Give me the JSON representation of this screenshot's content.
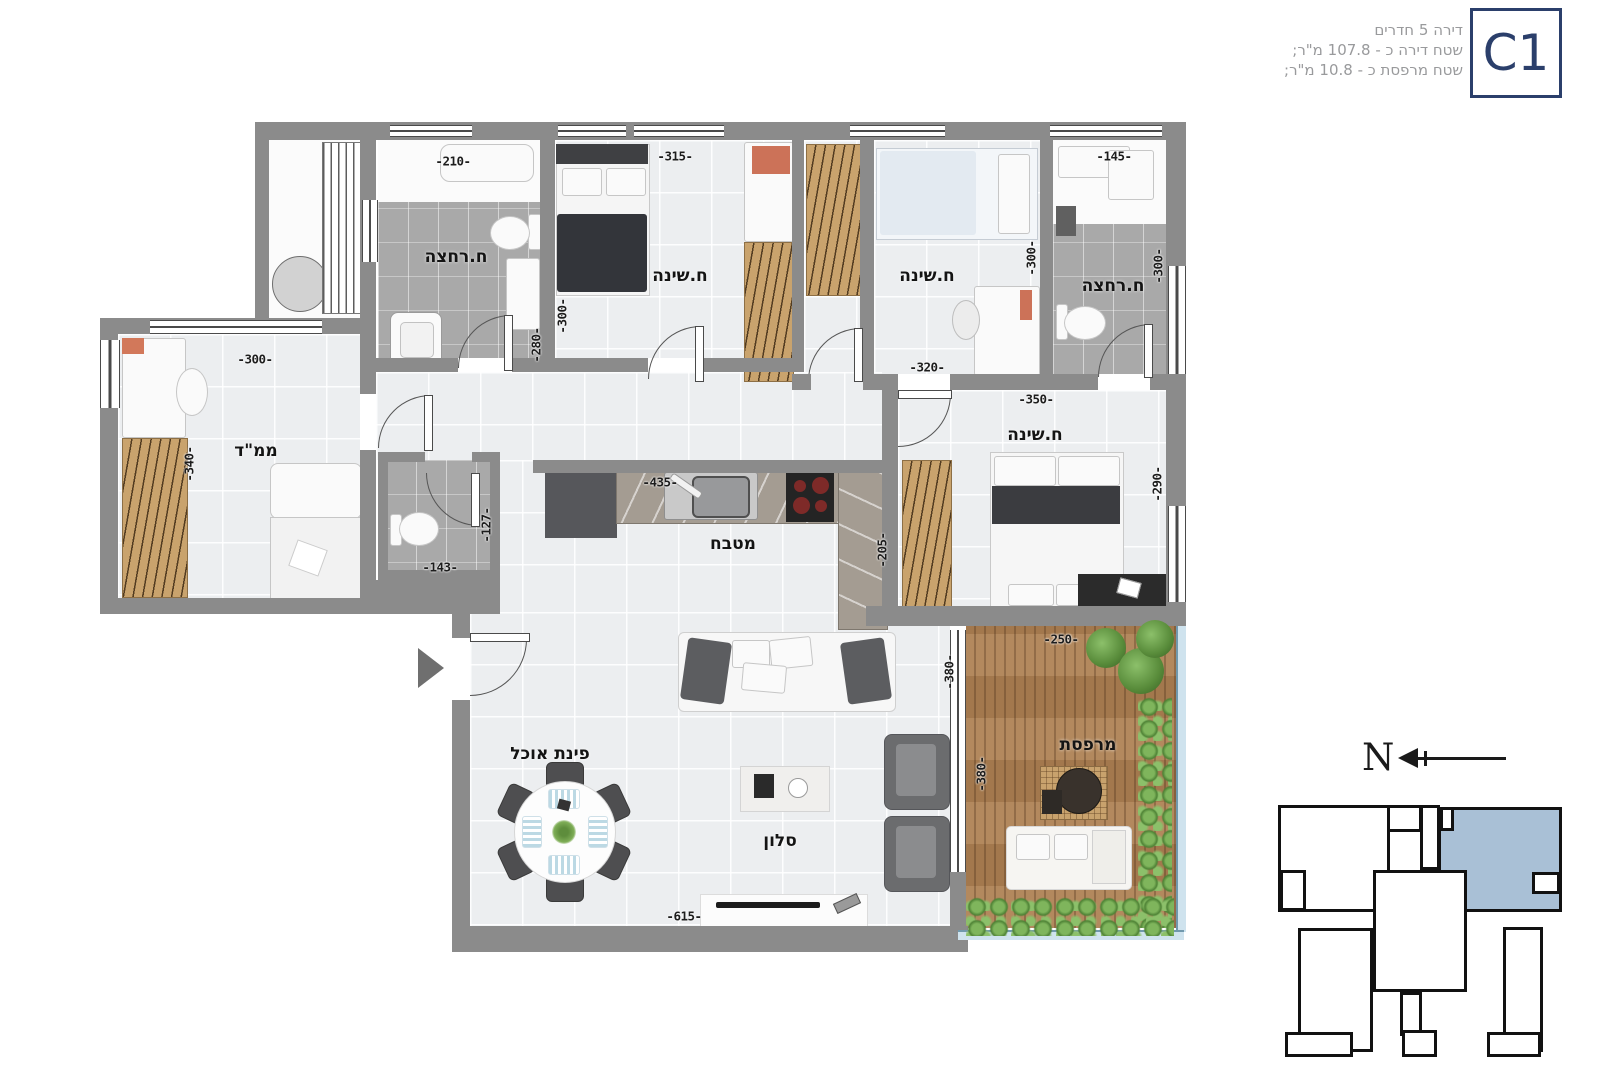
{
  "title_block": {
    "badge": "C1",
    "line1": "דירה 5 חדרים",
    "line2": "שטח דירה כ - 107.8 מ\"ר;",
    "line3": "שטח מרפסת כ - 10.8 מ\"ר;"
  },
  "room_labels": {
    "bathroom": "ח.רחצה",
    "bedroom": "ח.שינה",
    "safe_room": "ממ\"ד",
    "kitchen": "מטבח",
    "dining": "פינת אוכל",
    "living": "סלון",
    "balcony": "מרפסת"
  },
  "dimensions": {
    "d127": "-127-",
    "d143": "-143-",
    "d145": "-145-",
    "d205": "-205-",
    "d210": "-210-",
    "d250": "-250-",
    "d280": "-280-",
    "d290": "-290-",
    "d300": "-300-",
    "d315": "-315-",
    "d320": "-320-",
    "d340": "-340-",
    "d350": "-350-",
    "d380": "-380-",
    "d435": "-435-",
    "d615": "-615-"
  },
  "compass": {
    "north": "N"
  },
  "colors": {
    "wall": "#8b8b8b",
    "unit_highlight": "#a9c0d6",
    "badge_navy": "#2b3f6b",
    "wood": "#c9a36d",
    "hedge_green": "#6fa055"
  }
}
